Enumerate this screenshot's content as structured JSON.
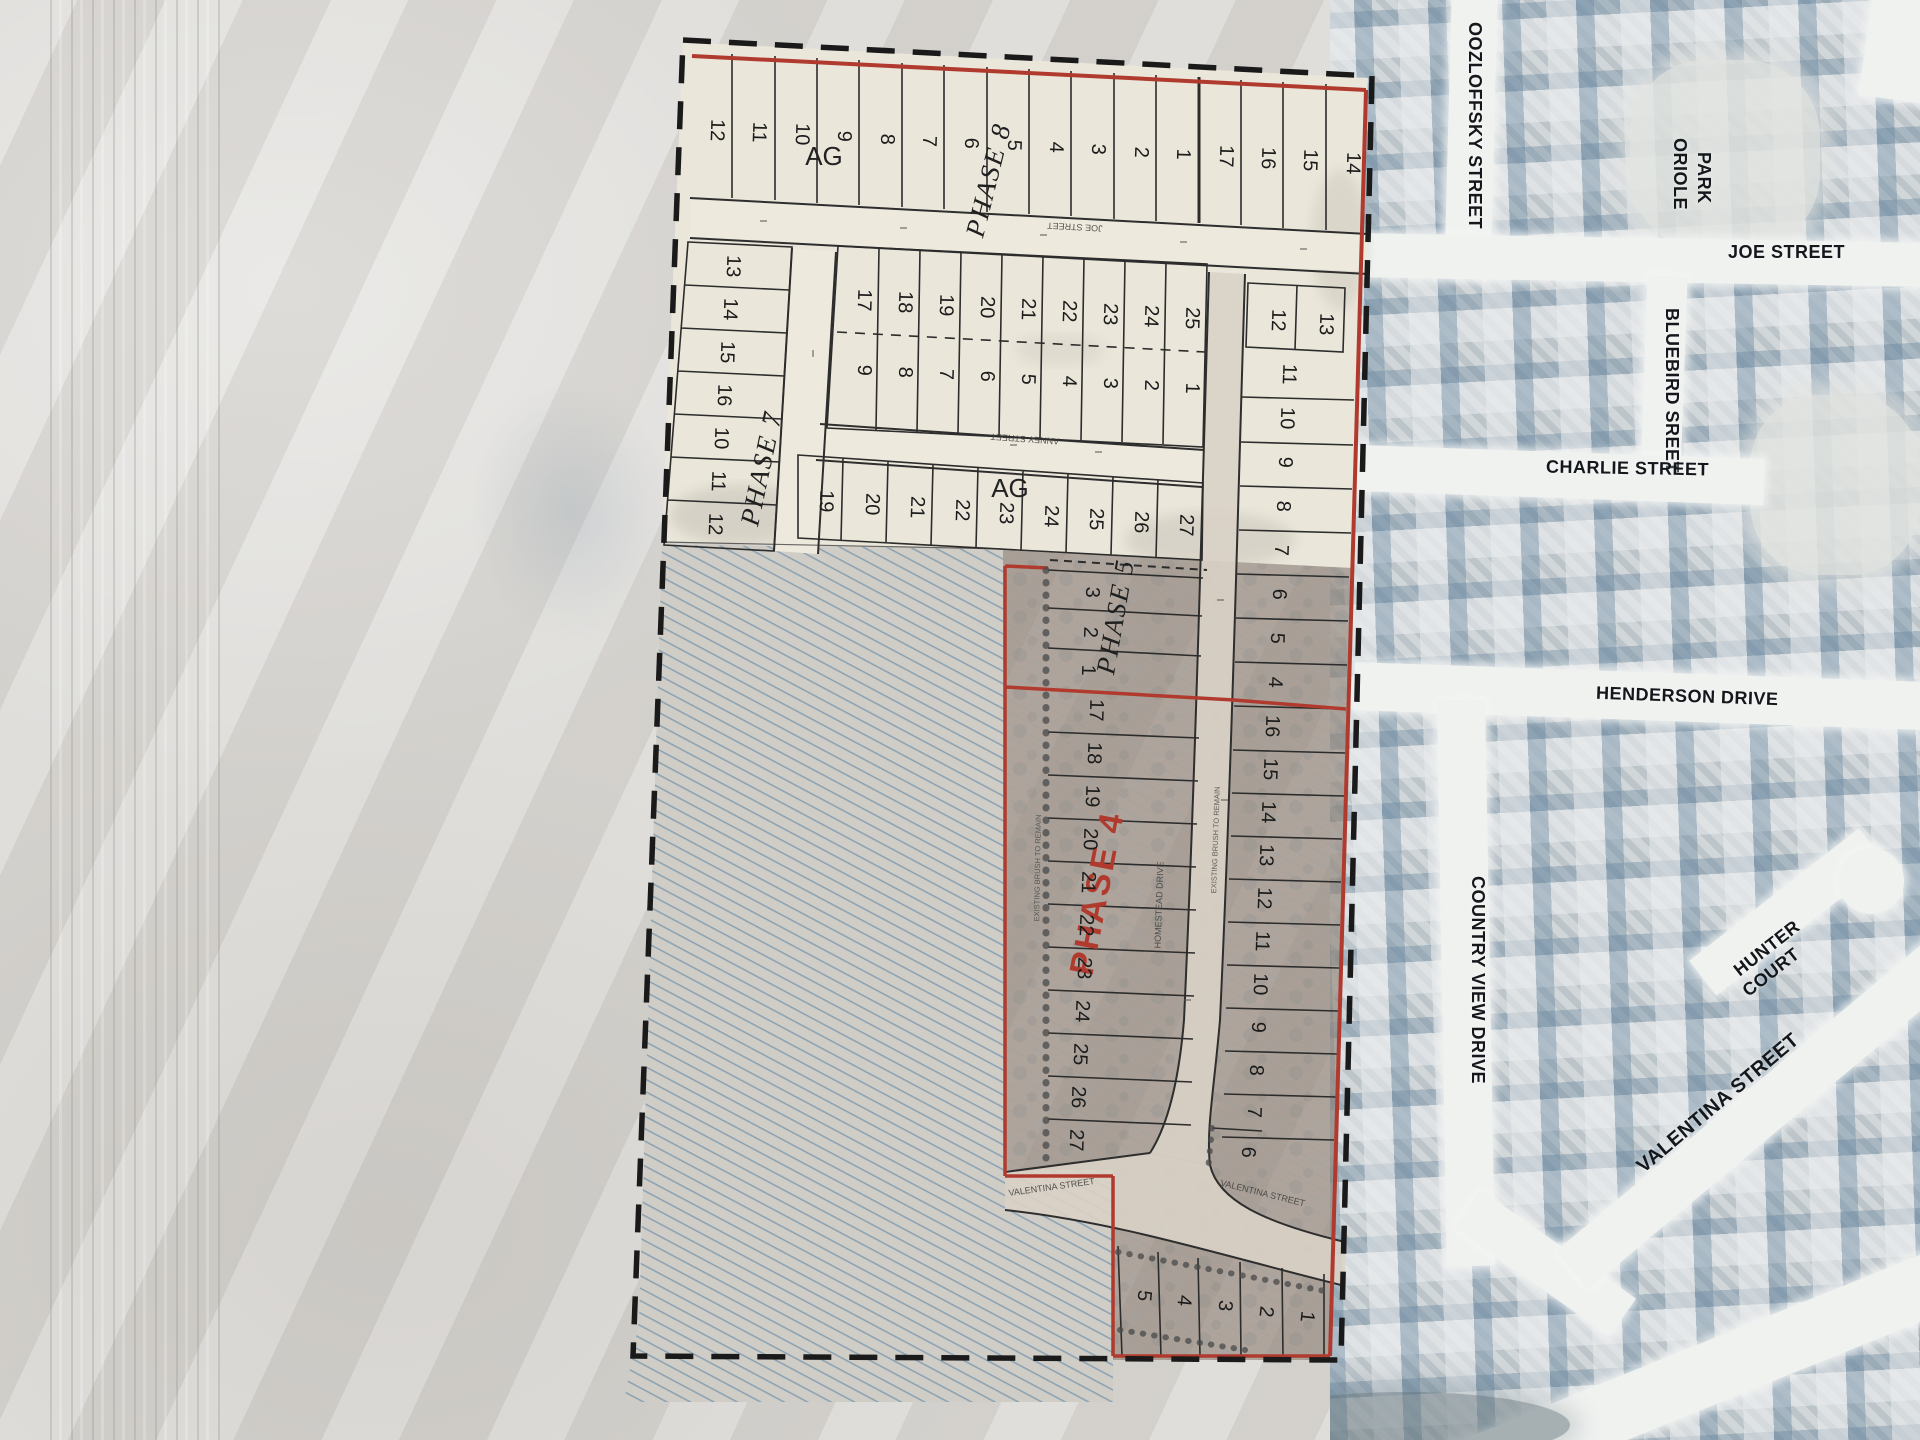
{
  "plat": {
    "phase_labels": {
      "phase8": "PHASE 8",
      "phase7": "PHASE 7",
      "phase5": "PHASE 5",
      "phase4": "PHASE 4"
    },
    "zoning_labels": {
      "ag_north": "AG",
      "ag_south": "AG"
    },
    "streets": {
      "joe": "JOE STREET",
      "anney": "ANNEY STREET",
      "ns_road": "HOMESTEAD DRIVE",
      "valentina_stub": "VALENTINA STREET",
      "valentina_south": "VALENTINA STREET"
    },
    "notes": {
      "brush1": "EXISTING BRUSH TO REMAIN",
      "brush2": "EXISTING BRUSH TO REMAIN"
    },
    "blocks": {
      "north_row": [
        "12",
        "11",
        "10",
        "9",
        "8",
        "7",
        "6",
        "5",
        "4",
        "3",
        "2",
        "1",
        "17",
        "16",
        "15",
        "14"
      ],
      "west_col": [
        "13",
        "14",
        "15",
        "16",
        "10",
        "11",
        "12"
      ],
      "mid_north": [
        "17",
        "18",
        "19",
        "20",
        "21",
        "22",
        "23",
        "24",
        "25"
      ],
      "mid_south": [
        "9",
        "8",
        "7",
        "6",
        "5",
        "4",
        "3",
        "2",
        "1"
      ],
      "ag_row": [
        "19",
        "20",
        "21",
        "22",
        "23",
        "24",
        "25",
        "26",
        "27"
      ],
      "ne_pair": [
        "12",
        "13"
      ],
      "east_col": [
        "11",
        "10",
        "9",
        "8",
        "7",
        "6",
        "5",
        "4"
      ],
      "p4_east": [
        "16",
        "15",
        "14",
        "13",
        "12",
        "11",
        "10",
        "9",
        "8",
        "7",
        "6"
      ],
      "p5_west": [
        "3",
        "2",
        "1"
      ],
      "p4_west": [
        "17",
        "18",
        "19",
        "20",
        "21",
        "22",
        "23",
        "24",
        "25",
        "26",
        "27"
      ],
      "south_row": [
        "5",
        "4",
        "3",
        "2",
        "1"
      ]
    },
    "colors": {
      "boundary_red": "#b03a2e",
      "paper": "#eae6da",
      "line": "#2c2c2c"
    }
  },
  "aerial": {
    "street_labels": {
      "oozloffsky": "OOZLOFFSKY STREET",
      "oriole_line1": "ORIOLE",
      "oriole_line2": "PARK",
      "joe": "JOE STREET",
      "bluebird": "BLUEBIRD SREET",
      "charlie": "CHARLIE STREET",
      "henderson": "HENDERSON DRIVE",
      "country_view": "COUNTRY VIEW DRIVE",
      "hunter_line1": "HUNTER",
      "hunter_line2": "COURT",
      "valentina": "VALENTINA STREET"
    }
  }
}
